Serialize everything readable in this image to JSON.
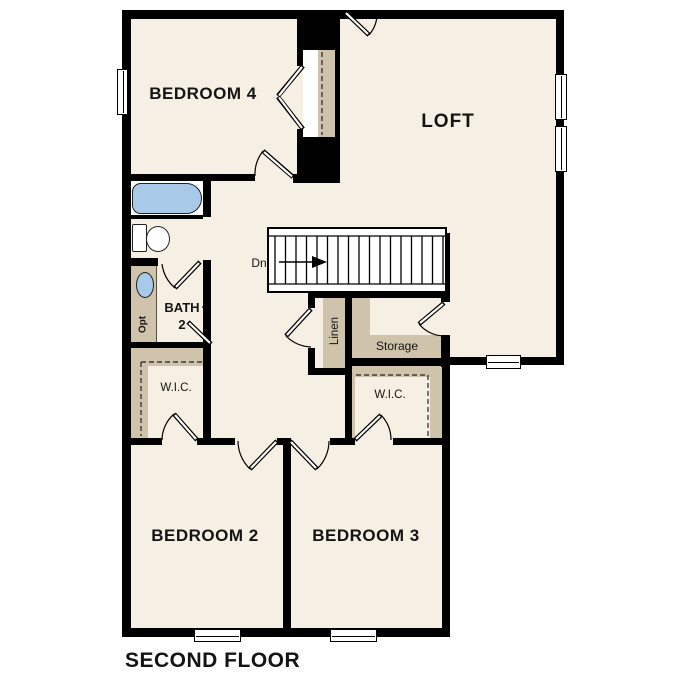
{
  "plan": {
    "title": "SECOND FLOOR",
    "labels": {
      "bedroom4": "BEDROOM 4",
      "loft": "LOFT",
      "bath_line1": "BATH",
      "bath_line2": "2",
      "wic_left": "W.I.C.",
      "wic_right": "W.I.C.",
      "linen": "Linen",
      "storage": "Storage",
      "stairs_direction": "Dn",
      "vanity_option": "Opt",
      "bedroom2": "BEDROOM 2",
      "bedroom3": "BEDROOM 3"
    },
    "colors": {
      "floor": "#f6efe3",
      "closet_shelf_tan": "#cfc3ab",
      "wall_black": "#000000",
      "fixture_blue": "#a9c9e9",
      "background_white": "#ffffff"
    }
  }
}
